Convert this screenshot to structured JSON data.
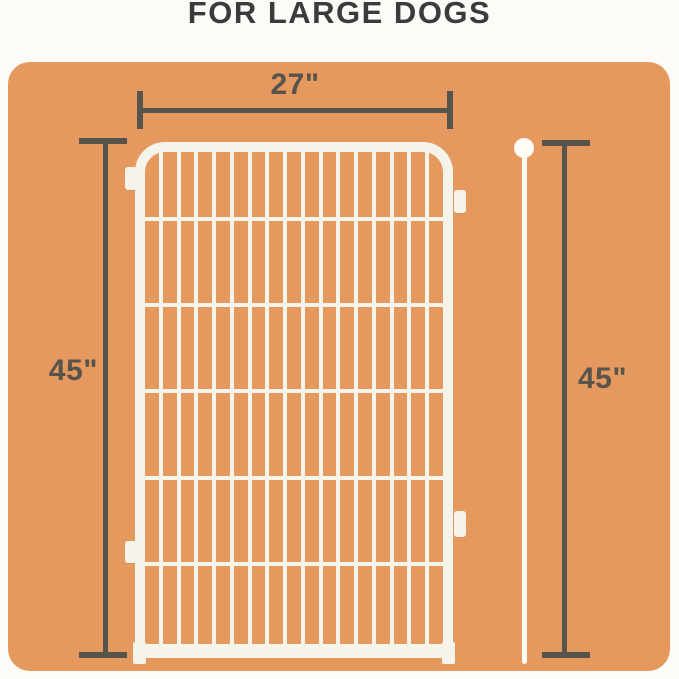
{
  "title": "FOR LARGE DOGS",
  "dimensions": {
    "width": "27\"",
    "height_left": "45\"",
    "height_right": "45\""
  },
  "fence": {
    "vertical_wires": 16,
    "horizontal_wires": 5,
    "description": "white wire pen panel"
  },
  "pole": {
    "description": "white connector rod with ball top"
  },
  "colors": {
    "page_bg": "#fcfbf7",
    "panel_bg": "#e6995f",
    "line": "#56544c",
    "title": "#3b3b3b",
    "fence": "#f6f3eb",
    "pole": "#fffdf5"
  }
}
